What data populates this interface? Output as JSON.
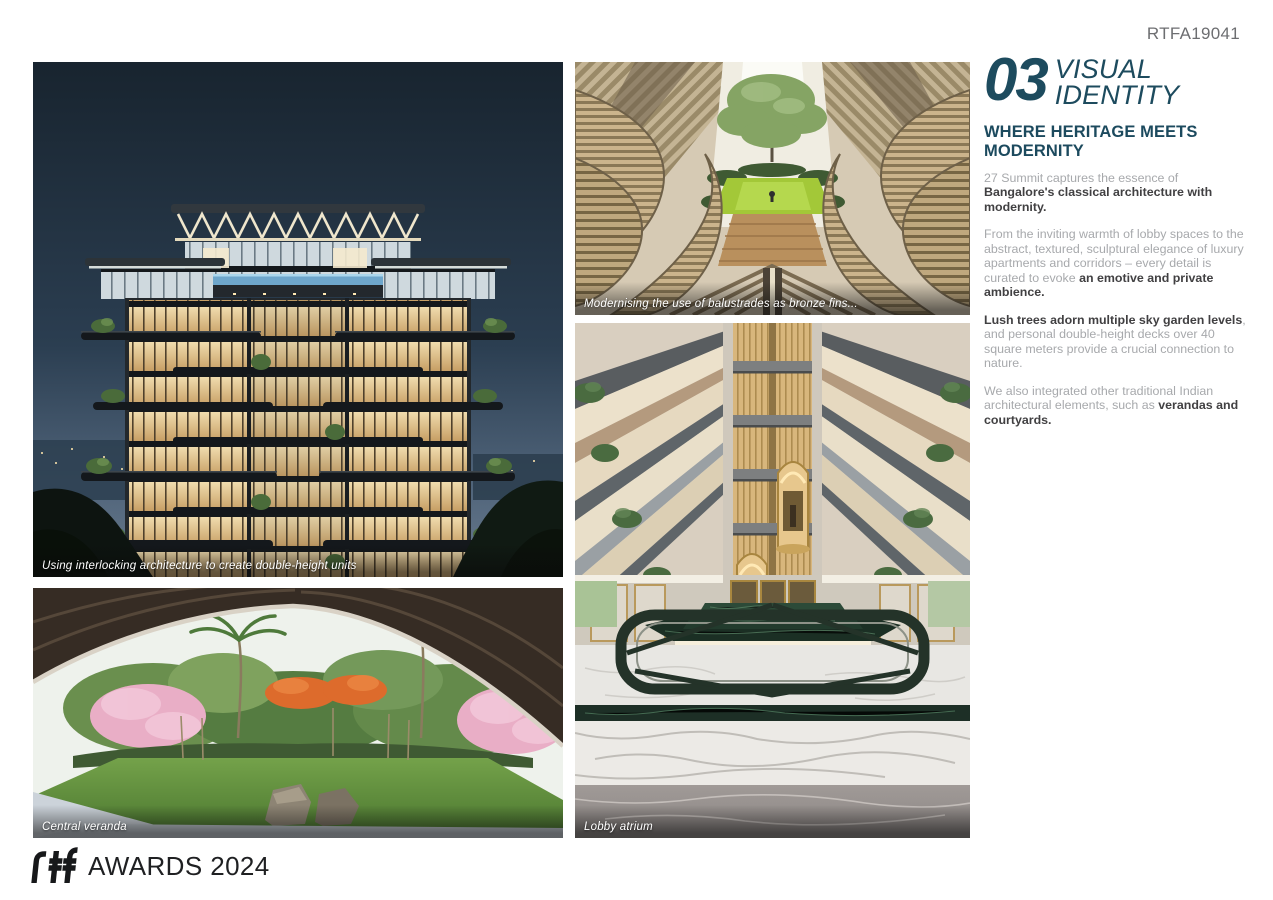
{
  "page": {
    "code": "RTFA19041"
  },
  "section": {
    "number": "03",
    "title_line1": "VISUAL",
    "title_line2": "IDENTITY",
    "heading": "WHERE HERITAGE MEETS MODERNITY",
    "paragraphs": [
      {
        "segments": [
          {
            "text": "27 Summit captures the essence of ",
            "bold": false
          },
          {
            "text": "Bangalore's classical architecture with modernity.",
            "bold": true
          }
        ]
      },
      {
        "segments": [
          {
            "text": "From the inviting warmth of lobby spaces to the abstract, textured, sculptural elegance of luxury apartments and corridors – every detail is curated to evoke ",
            "bold": false
          },
          {
            "text": "an emotive and private ambience.",
            "bold": true
          }
        ]
      },
      {
        "segments": [
          {
            "text": "Lush trees adorn multiple sky garden levels",
            "bold": true
          },
          {
            "text": ", and personal double-height decks over 40 square meters provide a crucial connection to nature.",
            "bold": false
          }
        ]
      },
      {
        "segments": [
          {
            "text": "We also integrated other traditional Indian architectural elements, such as ",
            "bold": false
          },
          {
            "text": "verandas and courtyards.",
            "bold": true
          }
        ]
      }
    ]
  },
  "photos": {
    "building": {
      "caption": "Using interlocking architecture to create double-height units"
    },
    "fins": {
      "caption": "Modernising the use of balustrades as bronze fins..."
    },
    "veranda": {
      "caption": "Central veranda"
    },
    "lobby": {
      "caption": "Lobby atrium"
    }
  },
  "footer": {
    "award_text": "AWARDS 2024"
  },
  "colors": {
    "accent_teal": "#1c4a5e",
    "body_gray": "#a7a9ac",
    "body_bold": "#414042",
    "code_gray": "#6d6e71",
    "caption_white": "#ffffff"
  }
}
